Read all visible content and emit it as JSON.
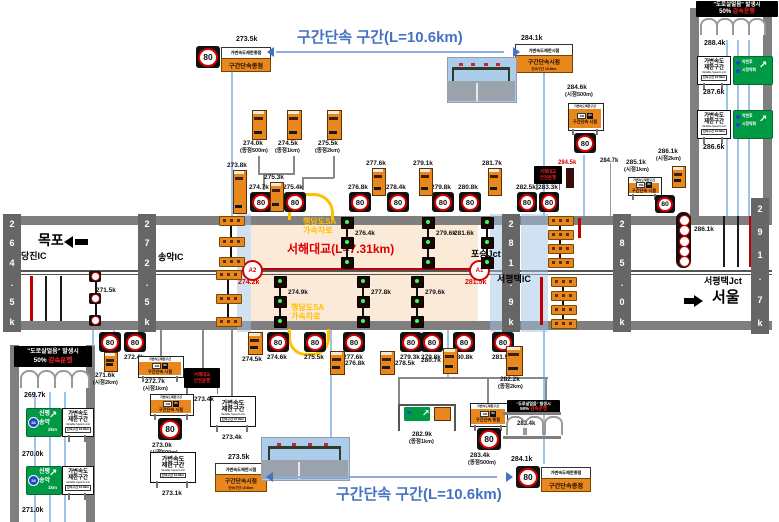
{
  "page": {
    "w": 779,
    "h": 522
  },
  "speed": "80",
  "titles": {
    "top": "구간단속 구간(L=10.6km)",
    "bottom": "구간단속 구간(L=10.6km)"
  },
  "ice_text": {
    "line1": "\"도로살얼음\" 발생시",
    "pct": "50%",
    "line2": "감속운행"
  },
  "led_text": {
    "line1": "서해대교",
    "line2": "안전운행"
  },
  "vsl_text": {
    "line1": "가변속도",
    "line2": "제한구간",
    "line3": "Variable Speed Limit",
    "line4": "단속구간 10.6km"
  },
  "combo_text": {
    "header": "가변속도제한구간",
    "prev": "100",
    "new": "80",
    "start": "구간단속 시점",
    "end": "구간단속 종점"
  },
  "end_text": {
    "vsl_end": "가변속도제한종점",
    "vsl_start": "가변속도제한시점",
    "sec_end": "구간단속종점",
    "sec_start": "구간단속시점",
    "sec_sub": "단속구간 10.6km"
  },
  "roadtext": {
    "mokpo": "목포",
    "dangjin": "당진IC",
    "songak": "송악IC",
    "poseung": "포승Jct",
    "sp_ic": "서평택IC",
    "sp_jct": "서평택Jct",
    "seoul": "서울"
  },
  "bridge": {
    "name": "서해대교(L=7.31km)",
    "sa1": "행담도SA\n가속차로",
    "sa2": "행담도SA\n가속차로",
    "a1": "A1",
    "a2": "A2",
    "a1_km": "281.5k",
    "a2_km": "274.2k"
  },
  "green_route": {
    "shield": "38",
    "dest1": "신평",
    "dest2": "송악",
    "arrow": "↗"
  },
  "green_cond": {
    "row1": "악천후",
    "row2": "시정악화",
    "arrow": "↗"
  },
  "roads": {
    "main": {
      "x": 3,
      "y": 216,
      "w": 769,
      "h": 114
    },
    "left": {
      "x": 10,
      "y": 345,
      "w": 85,
      "h": 177
    },
    "right": {
      "x": 690,
      "y": 8,
      "w": 82,
      "h": 208
    }
  },
  "peach": {
    "x": 251,
    "y": 225,
    "w": 227,
    "h": 96
  },
  "bands": [
    {
      "x": 237,
      "w": 14
    },
    {
      "x": 490,
      "w": 15
    },
    {
      "x": 521,
      "w": 27
    }
  ],
  "ic_bars": [
    {
      "x": 3,
      "y": 214,
      "h": 118,
      "text": "264.5k"
    },
    {
      "x": 138,
      "y": 214,
      "h": 118,
      "text": "272.5k"
    },
    {
      "x": 502,
      "y": 214,
      "h": 118,
      "text": "281.9k"
    },
    {
      "x": 613,
      "y": 214,
      "h": 118,
      "text": "285.0k"
    },
    {
      "x": 751,
      "y": 198,
      "h": 136,
      "text": "291.7k"
    }
  ],
  "top80": [
    {
      "x": 250,
      "l": "274.7k"
    },
    {
      "x": 284,
      "l": "275.4k"
    },
    {
      "x": 349,
      "l": "276.8k"
    },
    {
      "x": 387,
      "l": "278.4k"
    },
    {
      "x": 432,
      "l": "279.8k"
    },
    {
      "x": 459,
      "l": "280.8k"
    },
    {
      "x": 517,
      "l": "282.5k",
      "w": 20
    },
    {
      "x": 539,
      "l": "283.3k",
      "w": 20
    }
  ],
  "bottom80": [
    {
      "x": 99,
      "l": ""
    },
    {
      "x": 124,
      "l": "272.4k"
    },
    {
      "x": 267,
      "l": "274.6k"
    },
    {
      "x": 304,
      "l": "275.5k"
    },
    {
      "x": 343,
      "l": "277.6k"
    },
    {
      "x": 400,
      "l": "279.3k"
    },
    {
      "x": 421,
      "l": "279.8k"
    },
    {
      "x": 453,
      "l": "280.8k"
    },
    {
      "x": 492,
      "l": "281.5k"
    }
  ],
  "top_orange": [
    {
      "x": 233,
      "y": 170,
      "h": 42,
      "l": "273.8k"
    },
    {
      "x": 270,
      "y": 182,
      "h": 28,
      "l": "275.3k"
    },
    {
      "x": 372,
      "y": 168,
      "h": 26,
      "l": "277.6k"
    },
    {
      "x": 419,
      "y": 168,
      "h": 26,
      "l": "279.1k"
    },
    {
      "x": 488,
      "y": 168,
      "h": 26,
      "l": "281.7k"
    }
  ],
  "bottom_orange": [
    {
      "x": 248,
      "y": 332,
      "h": 21,
      "l": "274.5k",
      "lp": "below"
    },
    {
      "x": 330,
      "y": 351,
      "h": 22,
      "l": "276.8k",
      "lp": "right"
    },
    {
      "x": 380,
      "y": 351,
      "h": 22,
      "l": "278.5k",
      "lp": "right"
    },
    {
      "x": 443,
      "y": 348,
      "h": 24,
      "l": "280.7k",
      "lp": "left"
    }
  ],
  "tall_signs": [
    {
      "x": 252,
      "l1": "274.0k",
      "l2": "(종점500m)"
    },
    {
      "x": 287,
      "l1": "274.5k",
      "l2": "(종점1km)"
    },
    {
      "x": 327,
      "l1": "275.5k",
      "l2": "(종점2km)"
    }
  ],
  "tall_282": {
    "x": 506,
    "y": 346,
    "l1": "282.2k",
    "l2": "(종점2km)"
  },
  "small_orange": [
    {
      "x": 104,
      "y": 352,
      "h": 18,
      "l1": "271.6k",
      "l2": "(시점2km)",
      "lx": 95,
      "ly": 372
    },
    {
      "x": 672,
      "y": 166,
      "h": 20,
      "l1": "286.1k",
      "l2": "(시점2km)",
      "lx": 658,
      "ly": 148
    }
  ],
  "median_poles": [
    {
      "x": 341,
      "y": 217,
      "h": 50,
      "label": "276.4k",
      "side": "right"
    },
    {
      "x": 422,
      "y": 217,
      "h": 50,
      "label": "279.6k",
      "side": "right"
    },
    {
      "x": 481,
      "y": 217,
      "h": 50,
      "label": "281.6k",
      "side": "left"
    },
    {
      "x": 274,
      "y": 276,
      "h": 48,
      "label": "274.9k",
      "side": "right"
    },
    {
      "x": 357,
      "y": 276,
      "h": 48,
      "label": "277.8k",
      "side": "right"
    },
    {
      "x": 411,
      "y": 276,
      "h": 48,
      "label": "279.6k",
      "side": "right"
    }
  ],
  "pole_271": {
    "x": 89,
    "y": 271,
    "label": "271.5k"
  },
  "gantry_stacks": [
    {
      "x": 219,
      "ys": [
        216,
        237,
        257
      ]
    },
    {
      "x": 216,
      "ys": [
        270,
        294,
        317
      ]
    },
    {
      "x": 548,
      "ys": [
        216,
        230,
        244,
        258
      ]
    },
    {
      "x": 551,
      "ys": [
        277,
        291,
        305,
        319
      ]
    }
  ],
  "mini80_col": {
    "x": 676,
    "y": 212,
    "label": "286.1k"
  },
  "end_signs": [
    {
      "type": "end",
      "x": 196,
      "y": 46,
      "label": "273.5k",
      "lx": 236,
      "ly": 36
    },
    {
      "type": "start",
      "x": 515,
      "y": 44,
      "w": 56,
      "label": "284.1k",
      "lx": 521,
      "ly": 35
    },
    {
      "type": "start",
      "x": 215,
      "y": 463,
      "w": 50,
      "label": "273.5k",
      "lx": 228,
      "ly": 454
    },
    {
      "type": "end",
      "x": 516,
      "y": 466,
      "label": "284.1k",
      "lx": 511,
      "ly": 456
    }
  ],
  "combo_signs": [
    {
      "x": 138,
      "y": 356,
      "w": 44,
      "h": 20,
      "kind": "start",
      "l1": "272.7k",
      "l2": "(시점1km)",
      "lx": 145,
      "ly": 378
    },
    {
      "x": 150,
      "y": 394,
      "w": 42,
      "h": 20,
      "kind": "start",
      "l1": "273.0k",
      "l2": "(시점500m)",
      "lx": 152,
      "ly": 442,
      "s80": [
        158,
        418,
        24,
        22
      ]
    },
    {
      "x": 470,
      "y": 403,
      "w": 36,
      "h": 22,
      "kind": "end",
      "l1": "283.4k",
      "l2": "(종점500m)",
      "lx": 470,
      "ly": 452,
      "s80": [
        477,
        428,
        24,
        22
      ]
    },
    {
      "x": 568,
      "y": 103,
      "w": 34,
      "h": 26,
      "kind": "start",
      "l1": "284.6k",
      "l2": "(시점500m)",
      "lx": 567,
      "ly": 84,
      "above": true,
      "s80": [
        574,
        133,
        22,
        20
      ]
    },
    {
      "x": 628,
      "y": 177,
      "w": 32,
      "h": 17,
      "kind": "start",
      "l1": "285.1k",
      "l2": "(시점1km)",
      "lx": 626,
      "ly": 159,
      "above": true,
      "s80": [
        655,
        195,
        20,
        18
      ]
    }
  ],
  "vsl_signs": [
    {
      "x": 210,
      "y": 396,
      "w": 44,
      "h": 29,
      "label": "273.4k"
    },
    {
      "x": 150,
      "y": 452,
      "w": 44,
      "h": 29,
      "label": "273.1k"
    },
    {
      "x": 62,
      "y": 408,
      "w": 30,
      "h": 27
    },
    {
      "x": 62,
      "y": 466,
      "w": 30,
      "h": 27
    },
    {
      "x": 697,
      "y": 56,
      "w": 32,
      "h": 27
    },
    {
      "x": 697,
      "y": 110,
      "w": 32,
      "h": 27
    }
  ],
  "green_routes": [
    {
      "x": 26,
      "y": 408,
      "dist": "2km"
    },
    {
      "x": 26,
      "y": 466,
      "dist": "1km"
    }
  ],
  "green_conds": [
    {
      "x": 733,
      "y": 56
    },
    {
      "x": 733,
      "y": 110
    }
  ],
  "led_signs": [
    {
      "x": 534,
      "y": 166,
      "w": 28,
      "h": 18
    },
    {
      "x": 184,
      "y": 368,
      "w": 36,
      "h": 20,
      "label": "273.4k"
    }
  ],
  "ice_signs": [
    {
      "x": 696,
      "y": 1,
      "w": 82,
      "h": 16,
      "f": 5.5
    },
    {
      "x": 14,
      "y": 346,
      "w": 78,
      "h": 21,
      "f": 6
    },
    {
      "x": 507,
      "y": 400,
      "w": 53,
      "h": 13,
      "f": 4
    }
  ],
  "photos": [
    {
      "x": 447,
      "y": 57,
      "w": 68,
      "h": 44
    },
    {
      "x": 261,
      "y": 437,
      "w": 87,
      "h": 42
    }
  ],
  "gantry_282": {
    "x": 398,
    "y": 404,
    "l1": "282.9k",
    "l2": "(종점1km)"
  },
  "arcs_283": {
    "x": 503,
    "y": 412,
    "w": 58,
    "label": "283.4k"
  },
  "blue_arrows": [
    {
      "x1": 268,
      "x2": 512,
      "y": 52
    },
    {
      "x1": 267,
      "x2": 505,
      "y": 477
    }
  ],
  "red_arrow": {
    "x1": 253,
    "x2": 476,
    "y": 268
  },
  "a_pos": {
    "a2": {
      "x": 242,
      "y": 260
    },
    "a1": {
      "x": 469,
      "y": 260
    },
    "a2l": {
      "x": 238,
      "y": 279
    },
    "a1l": {
      "x": 465,
      "y": 279
    },
    "name": {
      "x": 287,
      "y": 243
    },
    "sa1": {
      "x": 303,
      "y": 218
    },
    "sa2": {
      "x": 291,
      "y": 304
    }
  },
  "roadtext_pos": {
    "mokpo": {
      "x": 38,
      "y": 233,
      "f": 14
    },
    "dangjin": {
      "x": 21,
      "y": 251,
      "f": 9
    },
    "songak": {
      "x": 158,
      "y": 252,
      "f": 9
    },
    "poseung": {
      "x": 471,
      "y": 249,
      "f": 9
    },
    "sp_ic": {
      "x": 497,
      "y": 274,
      "f": 9
    },
    "sp_jct": {
      "x": 704,
      "y": 276,
      "f": 9
    },
    "seoul": {
      "x": 712,
      "y": 290,
      "f": 15
    }
  },
  "misc_labels": [
    {
      "x": 704,
      "y": 40,
      "t": "288.4k"
    },
    {
      "x": 703,
      "y": 89,
      "t": "287.6k"
    },
    {
      "x": 703,
      "y": 144,
      "t": "286.6k"
    },
    {
      "x": 24,
      "y": 392,
      "t": "269.7k"
    },
    {
      "x": 22,
      "y": 451,
      "t": "270.0k"
    },
    {
      "x": 22,
      "y": 507,
      "t": "271.0k"
    },
    {
      "x": 600,
      "y": 158,
      "t": "284.7k",
      "f": 6
    },
    {
      "x": 558,
      "y": 160,
      "t": "284.5k",
      "f": 6,
      "c": "#d40000"
    },
    {
      "x": 96,
      "y": 287,
      "t": "271.5k",
      "f": 6.5
    }
  ],
  "lines": [
    [
      30,
      276,
      2.5,
      45,
      "#c00000"
    ],
    [
      45,
      276,
      2,
      45,
      "#1a1a1a"
    ],
    [
      60,
      276,
      2,
      45,
      "#1a1a1a"
    ],
    [
      578,
      218,
      2.5,
      20,
      "#c00000"
    ],
    [
      540,
      277,
      2.5,
      48,
      "#c00000"
    ],
    [
      723,
      216,
      2,
      51,
      "#1a1a1a"
    ],
    [
      737,
      216,
      2,
      51,
      "#1a1a1a"
    ],
    [
      749,
      216,
      2.5,
      51,
      "#c00000"
    ],
    [
      231,
      70,
      1.5,
      146,
      "B"
    ],
    [
      543,
      70,
      1.5,
      146,
      "B"
    ],
    [
      330,
      330,
      1.5,
      141,
      "B"
    ],
    [
      543,
      330,
      1.5,
      134,
      "B"
    ],
    [
      583,
      155,
      1.5,
      61,
      "B"
    ],
    [
      92,
      330,
      1.5,
      16,
      "B"
    ],
    [
      113,
      330,
      1.5,
      16,
      "B"
    ],
    [
      138,
      330,
      1.5,
      16,
      "B"
    ],
    [
      34,
      392,
      1.5,
      130,
      "B"
    ],
    [
      49,
      392,
      1.5,
      130,
      "B"
    ],
    [
      64,
      392,
      1.5,
      130,
      "B"
    ],
    [
      726,
      40,
      1.5,
      176,
      "B"
    ],
    [
      737,
      40,
      1.5,
      176,
      "B"
    ],
    [
      748,
      40,
      1.5,
      176,
      "B"
    ],
    [
      447,
      330,
      1.5,
      48,
      "B"
    ],
    [
      398,
      377,
      150,
      1.5,
      "#888"
    ],
    [
      398,
      378,
      1.5,
      27,
      "#888"
    ],
    [
      487,
      378,
      1.5,
      25,
      "#888"
    ],
    [
      545,
      378,
      1.5,
      34,
      "#888"
    ],
    [
      258,
      156,
      1.5,
      18,
      "#888"
    ],
    [
      293,
      156,
      1.5,
      18,
      "#888"
    ],
    [
      258,
      173,
      37,
      1.5,
      "#888"
    ],
    [
      263,
      173,
      1.5,
      17,
      "#888"
    ],
    [
      333,
      156,
      1.5,
      22,
      "#888"
    ],
    [
      302,
      177,
      32,
      1.5,
      "#888"
    ],
    [
      302,
      177,
      1.5,
      13,
      "#888"
    ],
    [
      160,
      330,
      1.5,
      26,
      "#888"
    ],
    [
      202,
      330,
      1.5,
      38,
      "#888"
    ],
    [
      231,
      330,
      1.5,
      66,
      "#888"
    ],
    [
      566,
      168,
      8,
      20,
      "#3a0d0d"
    ],
    [
      610,
      163,
      1,
      53,
      "#999"
    ]
  ]
}
